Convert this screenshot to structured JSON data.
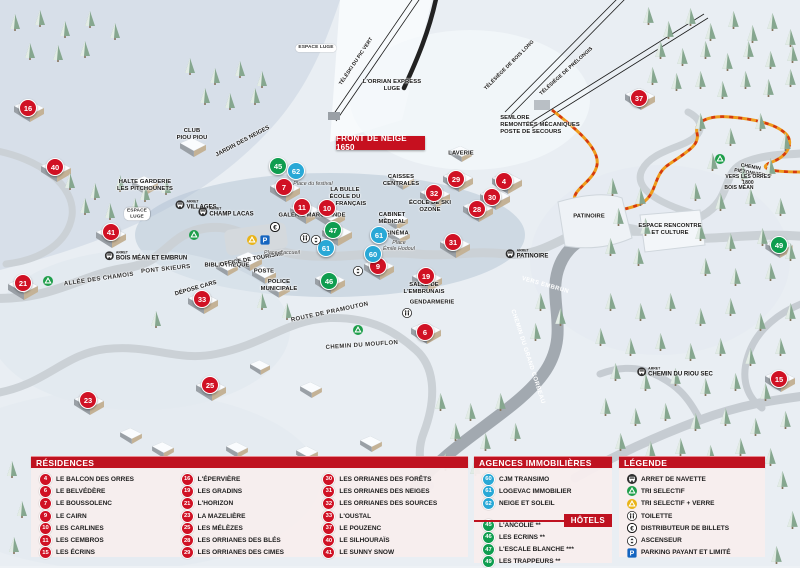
{
  "colors": {
    "residence": "#d01124",
    "hotel": "#0f9d4f",
    "agency": "#29a8d6",
    "header_red": "#bf1220"
  },
  "map": {
    "banner": "FRONT DE NEIGE 1650",
    "arret_label": "ARRET",
    "markers": [
      {
        "n": "16",
        "x": 28,
        "y": 108,
        "kind": "residence"
      },
      {
        "n": "40",
        "x": 55,
        "y": 167,
        "kind": "residence"
      },
      {
        "n": "41",
        "x": 111,
        "y": 232,
        "kind": "residence"
      },
      {
        "n": "21",
        "x": 23,
        "y": 283,
        "kind": "residence"
      },
      {
        "n": "33",
        "x": 202,
        "y": 299,
        "kind": "residence"
      },
      {
        "n": "23",
        "x": 88,
        "y": 400,
        "kind": "residence"
      },
      {
        "n": "25",
        "x": 210,
        "y": 385,
        "kind": "residence"
      },
      {
        "n": "7",
        "x": 284,
        "y": 187,
        "kind": "residence"
      },
      {
        "n": "11",
        "x": 302,
        "y": 207,
        "kind": "residence"
      },
      {
        "n": "10",
        "x": 327,
        "y": 208,
        "kind": "residence"
      },
      {
        "n": "9",
        "x": 378,
        "y": 266,
        "kind": "residence"
      },
      {
        "n": "29",
        "x": 456,
        "y": 179,
        "kind": "residence"
      },
      {
        "n": "4",
        "x": 504,
        "y": 181,
        "kind": "residence"
      },
      {
        "n": "32",
        "x": 434,
        "y": 193,
        "kind": "residence"
      },
      {
        "n": "30",
        "x": 492,
        "y": 197,
        "kind": "residence"
      },
      {
        "n": "28",
        "x": 477,
        "y": 209,
        "kind": "residence"
      },
      {
        "n": "31",
        "x": 453,
        "y": 242,
        "kind": "residence"
      },
      {
        "n": "19",
        "x": 426,
        "y": 276,
        "kind": "residence"
      },
      {
        "n": "6",
        "x": 425,
        "y": 332,
        "kind": "residence"
      },
      {
        "n": "37",
        "x": 639,
        "y": 98,
        "kind": "residence"
      },
      {
        "n": "15",
        "x": 779,
        "y": 379,
        "kind": "residence"
      },
      {
        "n": "45",
        "x": 278,
        "y": 166,
        "kind": "hotel"
      },
      {
        "n": "47",
        "x": 333,
        "y": 230,
        "kind": "hotel"
      },
      {
        "n": "46",
        "x": 329,
        "y": 281,
        "kind": "hotel"
      },
      {
        "n": "49",
        "x": 779,
        "y": 245,
        "kind": "hotel"
      },
      {
        "n": "62",
        "x": 296,
        "y": 171,
        "kind": "agency"
      },
      {
        "n": "61",
        "x": 326,
        "y": 248,
        "kind": "agency"
      },
      {
        "n": "61",
        "x": 379,
        "y": 235,
        "kind": "agency"
      },
      {
        "n": "60",
        "x": 373,
        "y": 254,
        "kind": "agency"
      }
    ],
    "labels": [
      {
        "t": "LAVERIE",
        "x": 461,
        "y": 154,
        "cls": "fac"
      },
      {
        "t": "CAISSES\nCENTRALES",
        "x": 401,
        "y": 181,
        "cls": "fac"
      },
      {
        "t": "LA BULLE\nÉCOLE DU\nSKI FRANÇAIS",
        "x": 345,
        "y": 197,
        "cls": "fac"
      },
      {
        "t": "GALERIE MARCHANDE",
        "x": 312,
        "y": 216,
        "cls": "fac"
      },
      {
        "t": "ÉCOLE DE SKI\nOZONE",
        "x": 430,
        "y": 207,
        "cls": "fac"
      },
      {
        "t": "CABINET\nMÉDICAL",
        "x": 392,
        "y": 219,
        "cls": "fac"
      },
      {
        "t": "CINÉMA",
        "x": 397,
        "y": 234,
        "cls": "fac"
      },
      {
        "t": "BIBLIOTHÈQUE",
        "x": 227,
        "y": 266,
        "cls": "fac"
      },
      {
        "t": "OFFICE DE TOURISME",
        "x": 252,
        "y": 260,
        "rot": -10,
        "cls": "fac"
      },
      {
        "t": "POSTE",
        "x": 264,
        "y": 272,
        "cls": "fac"
      },
      {
        "t": "POLICE\nMUNICIPALE",
        "x": 279,
        "y": 286,
        "cls": "fac"
      },
      {
        "t": "DÉPOSE CARS",
        "x": 196,
        "y": 289,
        "rot": -16,
        "cls": "fac"
      },
      {
        "t": "GENDARMERIE",
        "x": 432,
        "y": 303,
        "cls": "fac"
      },
      {
        "t": "SALLE DE\nL'EMBRUNAIS",
        "x": 424,
        "y": 289,
        "cls": "fac"
      },
      {
        "t": "PATINOIRE",
        "x": 589,
        "y": 217,
        "cls": "fac"
      },
      {
        "t": "ESPACE RENCONTRE\nET CULTURE",
        "x": 670,
        "y": 230,
        "cls": "fac"
      },
      {
        "t": "SEMLORE\nREMONTÉES MÉCANIQUES\nPOSTE DE SECOURS",
        "x": 540,
        "y": 125,
        "cls": "fac left"
      },
      {
        "t": "HALTE GARDERIE\nLES PITCHOUNETS",
        "x": 145,
        "y": 186,
        "cls": "fac"
      },
      {
        "t": "CLUB\nPIOU PIOU",
        "x": 192,
        "y": 135,
        "cls": "fac"
      },
      {
        "t": "JARDIN DES NEIGES",
        "x": 243,
        "y": 142,
        "rot": -28,
        "cls": "fac"
      },
      {
        "t": "Place du festival",
        "x": 313,
        "y": 184,
        "cls": "pl"
      },
      {
        "t": "Place d'accueil",
        "x": 282,
        "y": 253,
        "cls": "pl"
      },
      {
        "t": "Place\nÉmile Hodoul",
        "x": 399,
        "y": 246,
        "cls": "pl"
      },
      {
        "t": "ALLÉE DES CHAMOIS",
        "x": 99,
        "y": 280,
        "rot": -8,
        "cls": "road"
      },
      {
        "t": "PONT SKIEURS",
        "x": 166,
        "y": 270,
        "rot": -6,
        "cls": "road"
      },
      {
        "t": "ROUTE DE PRAMOUTON",
        "x": 330,
        "y": 313,
        "rot": -12,
        "cls": "road"
      },
      {
        "t": "CHEMIN DU MOUFLON",
        "x": 362,
        "y": 346,
        "rot": -4,
        "cls": "road"
      },
      {
        "t": "CHEMIN DU GRAND CORBEAU",
        "x": 527,
        "y": 357,
        "rot": 72,
        "cls": "roadw"
      },
      {
        "t": "VERS EMBRUN",
        "x": 545,
        "y": 286,
        "rot": 16,
        "cls": "roadw"
      },
      {
        "t": "TÉLÉSKI DU PIC VERT",
        "x": 357,
        "y": 62,
        "rot": -56,
        "cls": "lift"
      },
      {
        "t": "TÉLÉSIÈGE DE BOIS LONG",
        "x": 510,
        "y": 66,
        "rot": -45,
        "cls": "lift"
      },
      {
        "t": "TÉLÉSIÈGE DE PRÉLONGIS",
        "x": 567,
        "y": 72,
        "rot": -42,
        "cls": "lift"
      },
      {
        "t": "L'ORRIAN EXPRESS\nLUGE",
        "x": 392,
        "y": 86,
        "cls": "fac"
      },
      {
        "t": "CHEMIN PIÉTONNIER",
        "x": 750,
        "y": 171,
        "rot": 10,
        "cls": "lift"
      },
      {
        "t": "VERS LES ORRES 1800",
        "x": 748,
        "y": 181,
        "cls": "tiny"
      },
      {
        "t": "BOIS MÉAN",
        "x": 739,
        "y": 189,
        "cls": "tiny"
      },
      {
        "t": "ESPACE LUGE",
        "x": 316,
        "y": 48,
        "cls": "pill"
      },
      {
        "t": "ESPACE\nLUGE",
        "x": 137,
        "y": 214,
        "cls": "pill"
      }
    ],
    "bus_stops": [
      {
        "label": "VILLAGES",
        "x": 196,
        "y": 205
      },
      {
        "label": "CHAMP LACAS",
        "x": 226,
        "y": 212
      },
      {
        "label": "BOIS MÉAN ET EMBRUN",
        "x": 146,
        "y": 256
      },
      {
        "label": "PATINOIRE",
        "x": 527,
        "y": 254
      },
      {
        "label": "CHEMIN DU RIOU SEC",
        "x": 675,
        "y": 372
      }
    ],
    "icons": [
      {
        "icon": "tri",
        "x": 194,
        "y": 232
      },
      {
        "icon": "tri",
        "x": 48,
        "y": 278
      },
      {
        "icon": "tri",
        "x": 358,
        "y": 327
      },
      {
        "icon": "tri",
        "x": 720,
        "y": 156
      },
      {
        "icon": "tri_verre",
        "x": 252,
        "y": 237
      },
      {
        "icon": "parking",
        "x": 265,
        "y": 237
      },
      {
        "icon": "atm",
        "x": 275,
        "y": 224
      },
      {
        "icon": "wc",
        "x": 305,
        "y": 235
      },
      {
        "icon": "lift",
        "x": 316,
        "y": 237
      },
      {
        "icon": "lift",
        "x": 358,
        "y": 268
      },
      {
        "icon": "wc",
        "x": 407,
        "y": 310
      }
    ]
  },
  "legend": {
    "residences": {
      "title": "RÉSIDENCES",
      "col1": [
        {
          "n": "4",
          "label": "LE BALCON DES ORRES",
          "kind": "residence"
        },
        {
          "n": "6",
          "label": "LE BELVÉDÈRE",
          "kind": "residence"
        },
        {
          "n": "7",
          "label": "LE BOUSSOLENC",
          "kind": "residence"
        },
        {
          "n": "9",
          "label": "LE CAIRN",
          "kind": "residence"
        },
        {
          "n": "10",
          "label": "LES CARLINES",
          "kind": "residence"
        },
        {
          "n": "11",
          "label": "LES CEMBROS",
          "kind": "residence"
        },
        {
          "n": "15",
          "label": "LES ÉCRINS",
          "kind": "residence"
        }
      ],
      "col2": [
        {
          "n": "16",
          "label": "L'ÉPERVIÈRE",
          "kind": "residence"
        },
        {
          "n": "19",
          "label": "LES GRADINS",
          "kind": "residence"
        },
        {
          "n": "21",
          "label": "L'HORIZON",
          "kind": "residence"
        },
        {
          "n": "23",
          "label": "LA MAZELIÈRE",
          "kind": "residence"
        },
        {
          "n": "25",
          "label": "LES MÉLÈZES",
          "kind": "residence"
        },
        {
          "n": "28",
          "label": "LES ORRIANES DES BLÉS",
          "kind": "residence"
        },
        {
          "n": "29",
          "label": "LES ORRIANES DES CIMES",
          "kind": "residence"
        }
      ],
      "col3": [
        {
          "n": "30",
          "label": "LES ORRIANES DES FORÊTS",
          "kind": "residence"
        },
        {
          "n": "31",
          "label": "LES ORRIANES DES NEIGES",
          "kind": "residence"
        },
        {
          "n": "32",
          "label": "LES ORRIANES DES SOURCES",
          "kind": "residence"
        },
        {
          "n": "33",
          "label": "L'OUSTAL",
          "kind": "residence"
        },
        {
          "n": "37",
          "label": "LE POUZENC",
          "kind": "residence"
        },
        {
          "n": "40",
          "label": "LE SILHOURAÏS",
          "kind": "residence"
        },
        {
          "n": "41",
          "label": "LE SUNNY SNOW",
          "kind": "residence"
        }
      ]
    },
    "agences": {
      "title": "AGENCES IMMOBILIÈRES",
      "items": [
        {
          "n": "60",
          "label": "CJM TRANSIMO",
          "kind": "agency"
        },
        {
          "n": "61",
          "label": "LOGEVAC IMMOBILIER",
          "kind": "agency"
        },
        {
          "n": "62",
          "label": "NEIGE ET SOLEIL",
          "kind": "agency"
        }
      ]
    },
    "hotels": {
      "title": "HÔTELS",
      "items": [
        {
          "n": "45",
          "label": "L'ANCOLIE **",
          "kind": "hotel"
        },
        {
          "n": "46",
          "label": "LES ECRINS **",
          "kind": "hotel"
        },
        {
          "n": "47",
          "label": "L'ESCALE BLANCHE ***",
          "kind": "hotel"
        },
        {
          "n": "49",
          "label": "LES TRAPPEURS **",
          "kind": "hotel"
        }
      ]
    },
    "legende": {
      "title": "LÉGENDE",
      "items": [
        {
          "icon": "bus",
          "label": "ARRET DE NAVETTE"
        },
        {
          "icon": "tri",
          "label": "TRI SELECTIF"
        },
        {
          "icon": "tri_verre",
          "label": "TRI SELECTIF + VERRE"
        },
        {
          "icon": "wc",
          "label": "TOILETTE"
        },
        {
          "icon": "atm",
          "label": "DISTRIBUTEUR DE BILLETS"
        },
        {
          "icon": "lift",
          "label": "ASCENSEUR"
        },
        {
          "icon": "parking",
          "label": "PARKING PAYANT ET LIMITÉ"
        }
      ]
    }
  }
}
